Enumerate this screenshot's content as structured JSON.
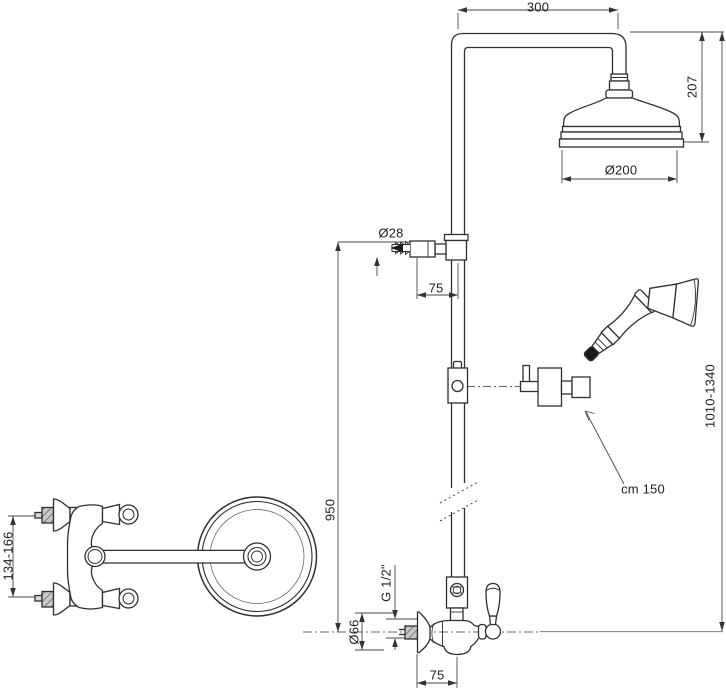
{
  "drawing": {
    "kind": "technical-dimension-drawing",
    "subject": "Shower column with overhead rain head, diverter hose outlet, hand shower and wall mixer (top view and side view)",
    "colors": {
      "background": "#ffffff",
      "line": "#2f2f2f",
      "dimension": "#4a4a4a",
      "hatch_fill": "#c8c8c8"
    }
  },
  "labels": {
    "arm_width": "300",
    "head_height": "207",
    "head_diameter": "Ø200",
    "overall_height": "1010-1340",
    "outlet_diameter": "Ø28",
    "outlet_depth": "75",
    "hose_length": "cm 150",
    "riser_height": "950",
    "inlet_thread": "G 1/2\"",
    "escutcheon_diameter": "Ø66",
    "valve_depth": "75",
    "inlet_spacing": "134-166"
  }
}
